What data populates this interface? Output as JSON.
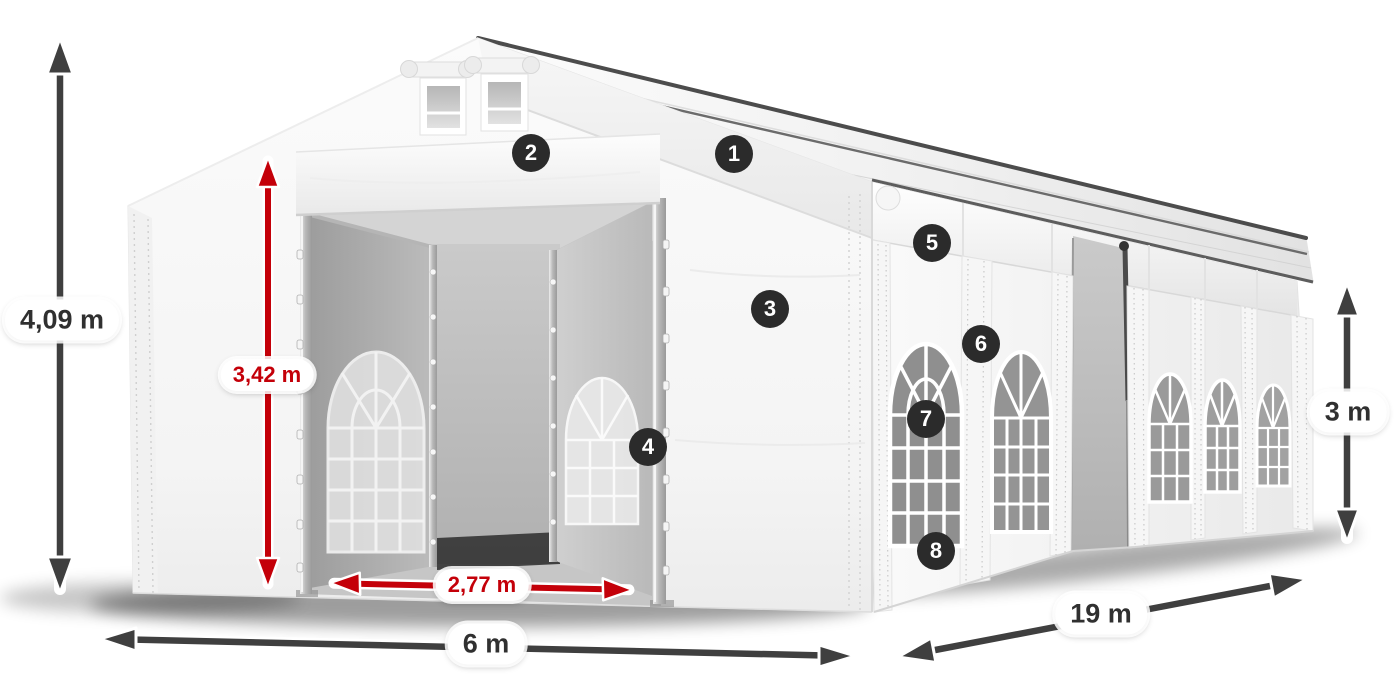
{
  "diagram": {
    "type": "product-dimension-diagram",
    "subject": "white marquee storage tent with open entrance, side windows and numbered part callouts"
  },
  "colors": {
    "red_accent": "#c40009",
    "arrow_dark": "#3f3f3f",
    "badge_bg": "#2b2b2b",
    "badge_text": "#ffffff",
    "pill_bg": "#ffffff",
    "pill_text": "#303030",
    "tent_white": "#f7f7f7",
    "glass_gray": "#8f8f8f"
  },
  "dimensions": {
    "total_height": "4,09 m",
    "inner_height": "3,42 m",
    "entrance_width": "2,77 m",
    "width": "6 m",
    "length": "19 m",
    "side_height": "3 m"
  },
  "badges": [
    {
      "number": "1"
    },
    {
      "number": "2"
    },
    {
      "number": "3"
    },
    {
      "number": "4"
    },
    {
      "number": "5"
    },
    {
      "number": "6"
    },
    {
      "number": "7"
    },
    {
      "number": "8"
    }
  ]
}
